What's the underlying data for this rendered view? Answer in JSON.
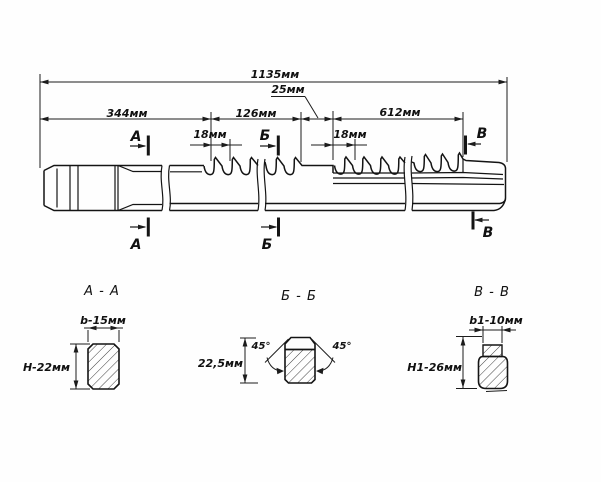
{
  "dimensions": {
    "total": "1135мм",
    "shank": "344мм",
    "first_tooth_section": "126мм",
    "land": "25мм",
    "working_section": "612мм",
    "tooth_pitch_1": "18мм",
    "tooth_pitch_2": "18мм"
  },
  "section_markers": {
    "a": "А",
    "b": "Б",
    "v": "В"
  },
  "section_views": {
    "aa": {
      "title": "А - А",
      "width": "b-15мм",
      "height": "Н-22мм"
    },
    "bb": {
      "title": "Б - Б",
      "height": "22,5мм",
      "angle_left": "45°",
      "angle_right": "45°"
    },
    "vv": {
      "title": "В - В",
      "width": "b1-10мм",
      "height": "Н1-26мм"
    }
  }
}
